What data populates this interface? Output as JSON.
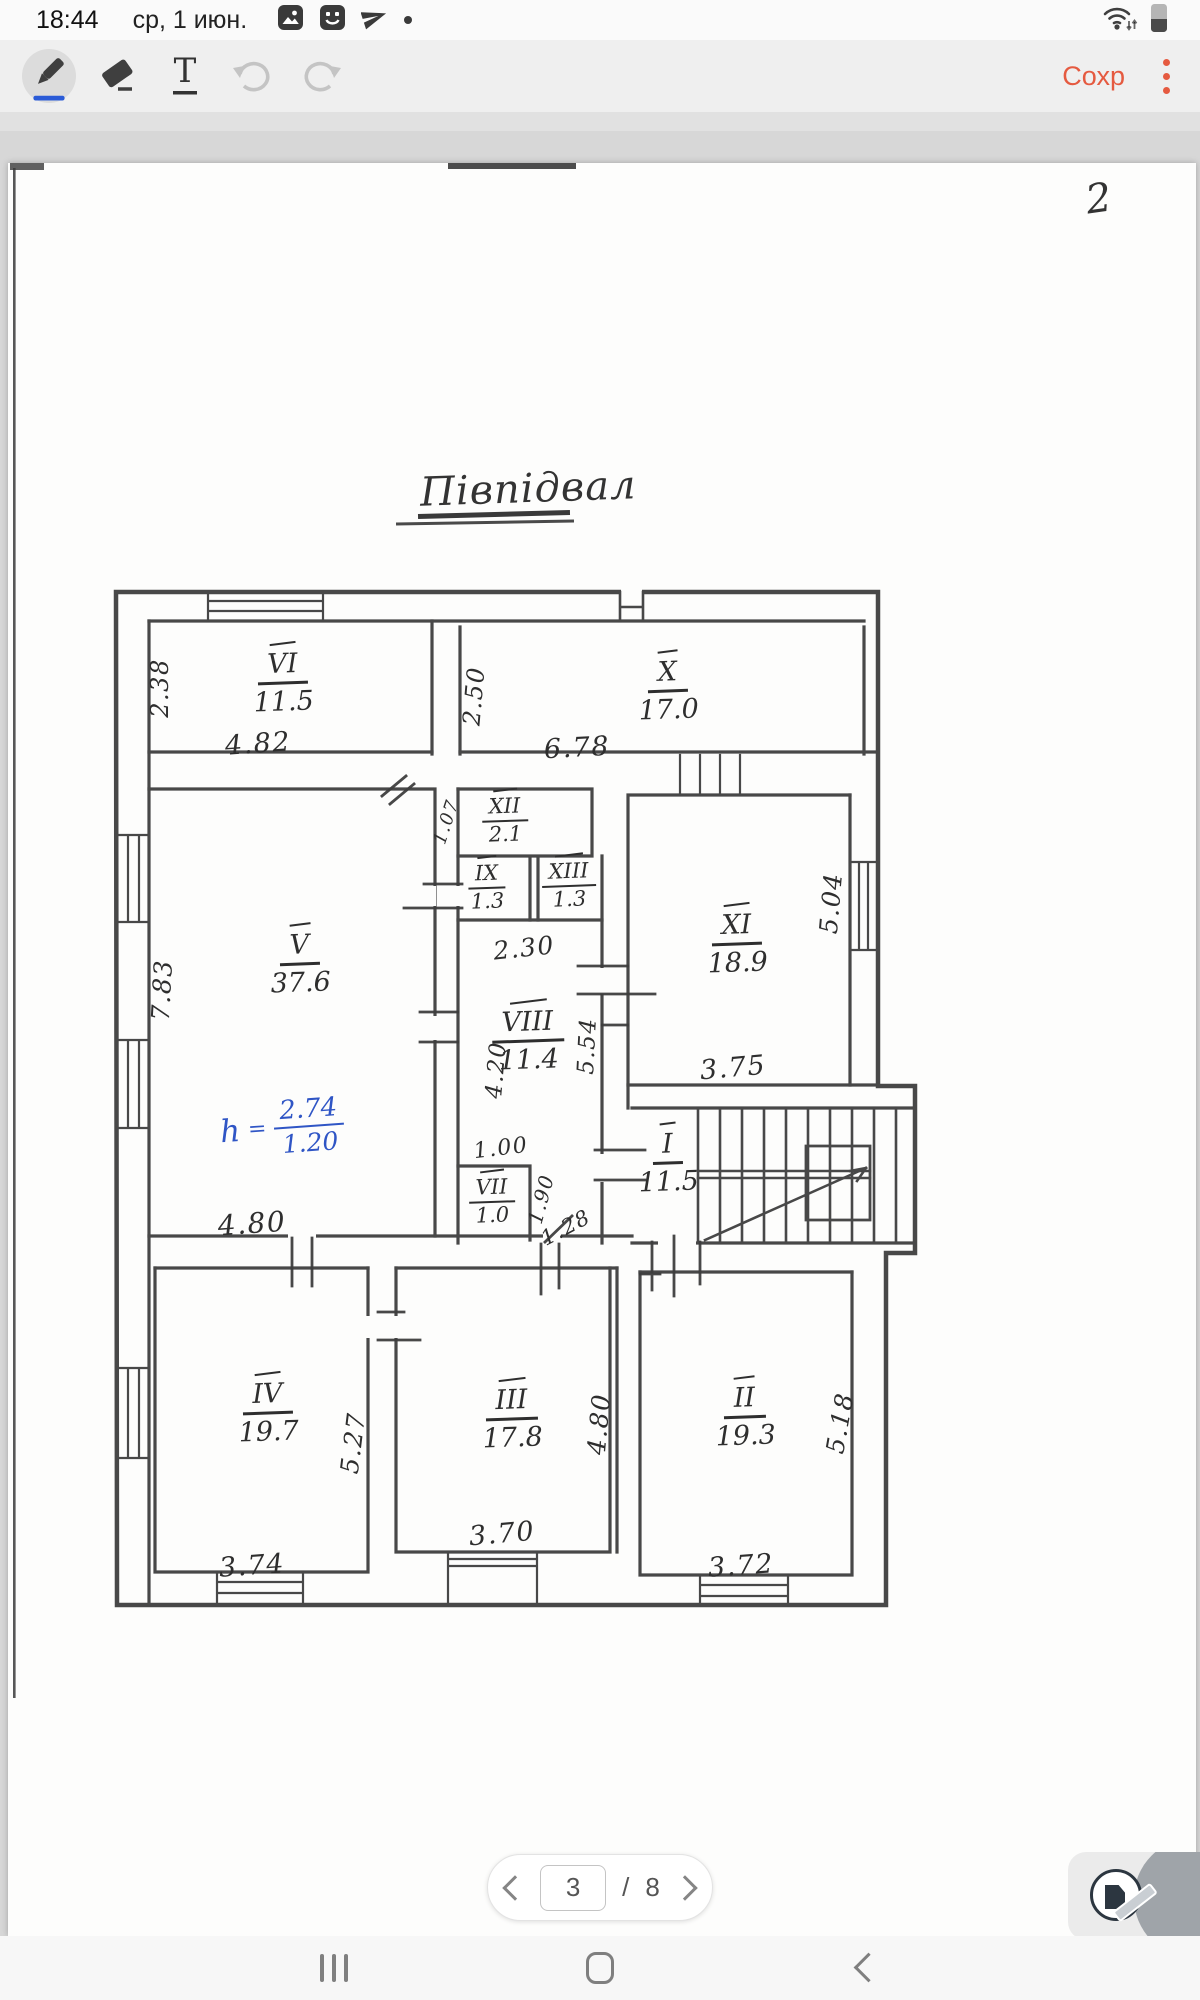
{
  "status_bar": {
    "time": "18:44",
    "date": "ср, 1 июн.",
    "notification_icons": [
      "image-thumbnail-icon",
      "smiley-app-icon",
      "telegram-icon",
      "more-notification-dot"
    ],
    "system_icons": [
      "wifi-icon",
      "battery-icon"
    ]
  },
  "toolbar": {
    "save": "Сохр",
    "accent_color": "#e55a40",
    "tools": [
      "pen-tool",
      "eraser-tool",
      "text-tool",
      "undo",
      "redo"
    ],
    "selected_tool": "pen-tool",
    "pen_underline_color": "#2a5bd7"
  },
  "page_annotations": {
    "corner_number": "2",
    "title": "Півпідвал",
    "height_note": {
      "label": "h",
      "equals": "=",
      "numerator": "2.74",
      "denominator": "1.20",
      "color": "#2f55c5"
    }
  },
  "plan": {
    "rooms": [
      {
        "numeral": "VI",
        "area": "11.5",
        "x": 283,
        "y": 682
      },
      {
        "numeral": "X",
        "area": "17.0",
        "x": 668,
        "y": 690
      },
      {
        "numeral": "XII",
        "area": "2.1",
        "x": 505,
        "y": 820,
        "small": true
      },
      {
        "numeral": "IX",
        "area": "1.3",
        "x": 487,
        "y": 887,
        "small": true
      },
      {
        "numeral": "XIII",
        "area": "1.3",
        "x": 569,
        "y": 885,
        "small": true
      },
      {
        "numeral": "V",
        "area": "37.6",
        "x": 300,
        "y": 963
      },
      {
        "numeral": "XI",
        "area": "18.9",
        "x": 737,
        "y": 943
      },
      {
        "numeral": "VIII",
        "area": "11.4",
        "x": 528,
        "y": 1040
      },
      {
        "numeral": "VII",
        "area": "1.0",
        "x": 492,
        "y": 1201,
        "small": true
      },
      {
        "numeral": "I",
        "area": "11.5",
        "x": 668,
        "y": 1162
      },
      {
        "numeral": "IV",
        "area": "19.7",
        "x": 268,
        "y": 1412
      },
      {
        "numeral": "III",
        "area": "17.8",
        "x": 512,
        "y": 1418
      },
      {
        "numeral": "II",
        "area": "19.3",
        "x": 745,
        "y": 1416
      }
    ],
    "dimensions": [
      {
        "text": "2.38",
        "x": 160,
        "y": 688,
        "rot": -90,
        "fs": 24
      },
      {
        "text": "4.82",
        "x": 258,
        "y": 744,
        "rot": -4,
        "fs": 27
      },
      {
        "text": "2.50",
        "x": 474,
        "y": 696,
        "rot": -85,
        "fs": 24
      },
      {
        "text": "6.78",
        "x": 577,
        "y": 748,
        "rot": -3,
        "fs": 27
      },
      {
        "text": "7.83",
        "x": 162,
        "y": 990,
        "rot": -87,
        "fs": 25
      },
      {
        "text": "1.07",
        "x": 447,
        "y": 822,
        "rot": -72,
        "fs": 18
      },
      {
        "text": "2.30",
        "x": 524,
        "y": 948,
        "rot": -6,
        "fs": 25
      },
      {
        "text": "4.20",
        "x": 497,
        "y": 1070,
        "rot": -85,
        "fs": 23
      },
      {
        "text": "5.54",
        "x": 588,
        "y": 1046,
        "rot": -87,
        "fs": 23
      },
      {
        "text": "5.04",
        "x": 831,
        "y": 903,
        "rot": -85,
        "fs": 25
      },
      {
        "text": "3.75",
        "x": 733,
        "y": 1068,
        "rot": -5,
        "fs": 27
      },
      {
        "text": "1.00",
        "x": 501,
        "y": 1149,
        "rot": -7,
        "fs": 22
      },
      {
        "text": "1.90",
        "x": 541,
        "y": 1199,
        "rot": -75,
        "fs": 20
      },
      {
        "text": "1.28",
        "x": 566,
        "y": 1228,
        "rot": -28,
        "fs": 21
      },
      {
        "text": "4.80",
        "x": 252,
        "y": 1224,
        "rot": -4,
        "fs": 28
      },
      {
        "text": "5.27",
        "x": 353,
        "y": 1443,
        "rot": -83,
        "fs": 25
      },
      {
        "text": "3.74",
        "x": 252,
        "y": 1566,
        "rot": -4,
        "fs": 27
      },
      {
        "text": "3.70",
        "x": 502,
        "y": 1534,
        "rot": -5,
        "fs": 27
      },
      {
        "text": "4.80",
        "x": 599,
        "y": 1424,
        "rot": -85,
        "fs": 25
      },
      {
        "text": "5.18",
        "x": 840,
        "y": 1423,
        "rot": -80,
        "fs": 25
      },
      {
        "text": "3.72",
        "x": 741,
        "y": 1566,
        "rot": -4,
        "fs": 27
      }
    ]
  },
  "pager": {
    "current": "3",
    "separator": "/",
    "total": "8",
    "icons": [
      "chevron-left-icon",
      "chevron-right-icon"
    ]
  },
  "nav_bar": {
    "buttons": [
      "recents",
      "home",
      "back"
    ]
  },
  "fab": {
    "icon": "edit-page-icon"
  }
}
